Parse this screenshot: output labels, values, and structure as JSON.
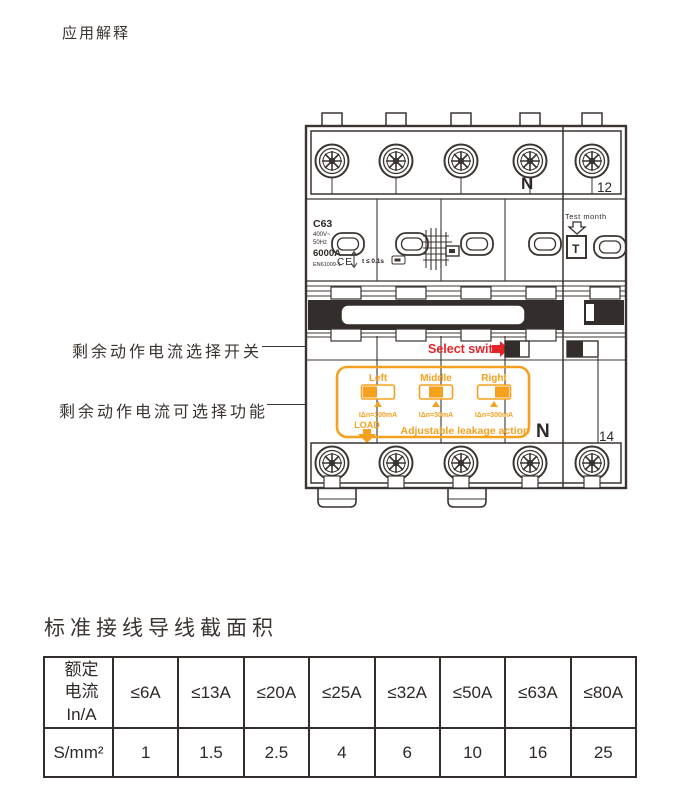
{
  "page": {
    "title": "应用解释"
  },
  "diagram": {
    "callout_select_switch": "剩余动作电流选择开关",
    "callout_selectable_function": "剩余动作电流可选择功能",
    "breaker": {
      "model": "C63",
      "voltage": "400V~",
      "frequency": "50Hz",
      "breaking_capacity": "6000A",
      "standard": "EN61009-1",
      "ce_mark": "CE",
      "trip_time": "t ≤ 0.1s",
      "neutral_top": "N",
      "terminal_top": "12",
      "test_label": "Test month",
      "test_button": "T",
      "select_switch_label": "Select switch",
      "panel": {
        "pos_left": "Left",
        "pos_middle": "Middle",
        "pos_right": "Right",
        "val_left": "IΔn=100mA",
        "val_middle": "IΔn=30mA",
        "val_right": "IΔn=300mA",
        "load": "LOAD",
        "caption": "Adjustable leakage action"
      },
      "neutral_bottom": "N",
      "terminal_bottom": "14"
    }
  },
  "wiring_table": {
    "title": "标准接线导线截面积",
    "row1_label": "额定\n电流\nIn/A",
    "row2_label": "S/mm²",
    "columns": [
      "≤6A",
      "≤13A",
      "≤20A",
      "≤25A",
      "≤32A",
      "≤50A",
      "≤63A",
      "≤80A"
    ],
    "values": [
      "1",
      "1.5",
      "2.5",
      "4",
      "6",
      "10",
      "16",
      "25"
    ]
  },
  "colors": {
    "orange": "#F5A11E",
    "red": "#E52329",
    "ink": "#3b3431"
  }
}
